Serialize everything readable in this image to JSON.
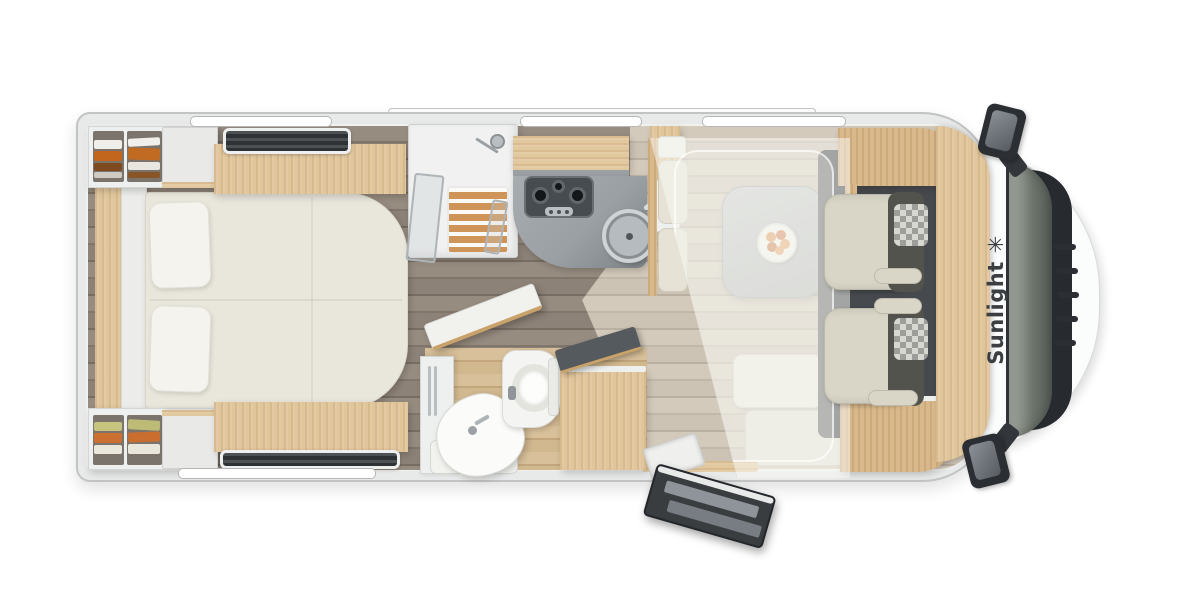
{
  "meta": {
    "type": "motorhome-floor-plan",
    "view": "top-down",
    "description": "Top view floor plan of a Sunlight motorhome with rear island bed, shower, kitchenette, washroom, half-dinette, drop-down bed and driver cab"
  },
  "brand": {
    "name": "Sunlight",
    "logo_glyph": "✳"
  },
  "areas": [
    {
      "id": "bedroom",
      "name": "rear-island-bed"
    },
    {
      "id": "wardrobe-top",
      "name": "wardrobe-with-clothes-top"
    },
    {
      "id": "wardrobe-bottom",
      "name": "wardrobe-with-clothes-bottom"
    },
    {
      "id": "shower",
      "name": "shower-cabin"
    },
    {
      "id": "kitchen",
      "name": "kitchenette-3-burner-hob-and-sink"
    },
    {
      "id": "washroom",
      "name": "washroom-toilet-and-basin"
    },
    {
      "id": "dinette",
      "name": "half-dinette-with-table"
    },
    {
      "id": "drop-down-bed",
      "name": "drop-down-bed-stowed-translucent"
    },
    {
      "id": "cab",
      "name": "driver-cab-two-swivel-seats"
    },
    {
      "id": "entry",
      "name": "entrance-door-open-with-steps"
    }
  ],
  "palette": {
    "body_white": "#fbfcfc",
    "wall_grey": "#d8d9d9",
    "floor_dark": "#8d8277",
    "floor_light": "#cdc3b4",
    "floor_washroom": "#d2b88f",
    "wood_light": "#e1c69c",
    "wood_mid": "#d9b98c",
    "bed_cream": "#e9e6db",
    "counter_grey": "#a2a8ab",
    "stove_dark": "#474c50",
    "cab_floor": "#46494d",
    "windshield_glass": "#6d746c",
    "seat_cream": "#d9d6c7",
    "seat_dark": "#53534d",
    "clothes_orange": "#c2651d",
    "clothes_olive": "#c6c47e",
    "brand_text": "#3b3f42"
  }
}
